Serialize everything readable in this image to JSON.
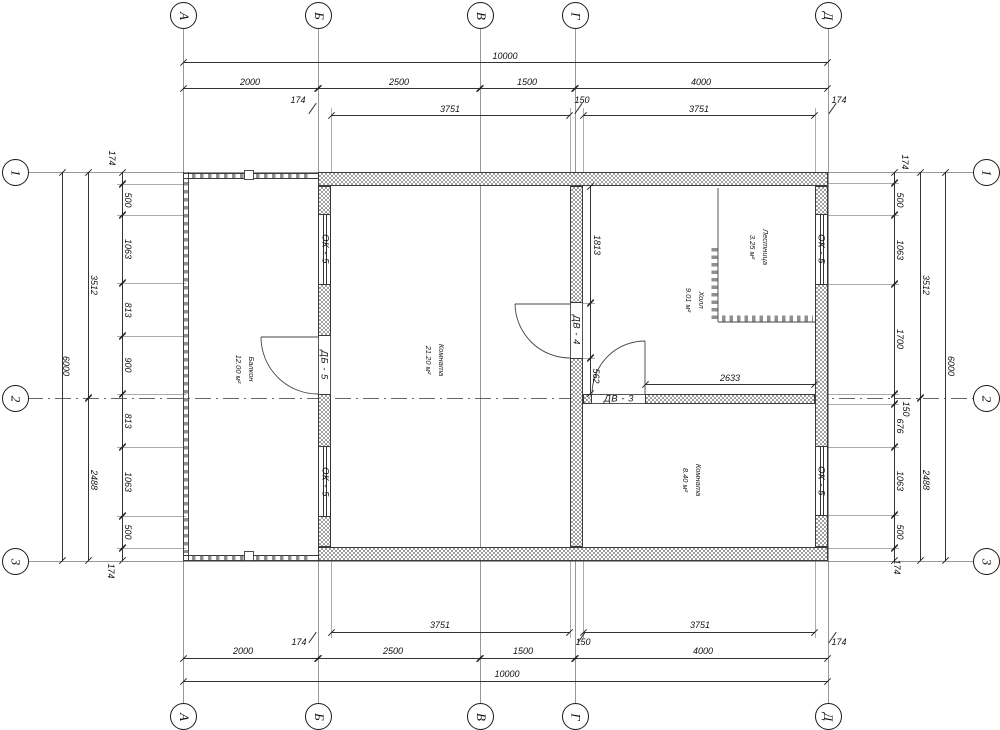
{
  "sheet": {
    "type": "architectural floor plan",
    "line_color": "#2f2f2f",
    "hatch_color": "#9f9f9f"
  },
  "axes": {
    "cols": [
      "А",
      "Б",
      "В",
      "Г",
      "Д"
    ],
    "rows": [
      "1",
      "2",
      "3"
    ]
  },
  "dims": {
    "top": {
      "overall": "10000",
      "segments": [
        "2000",
        "2500",
        "1500",
        "4000"
      ],
      "detail": [
        "174",
        "3751",
        "150",
        "3751",
        "174"
      ]
    },
    "bottom": {
      "overall": "10000",
      "segments": [
        "2000",
        "2500",
        "1500",
        "4000"
      ],
      "detail": [
        "174",
        "3751",
        "150",
        "3751",
        "174"
      ]
    },
    "left": {
      "overall": "6000",
      "spans": [
        "3512",
        "2488"
      ],
      "chain": [
        "174",
        "500",
        "1063",
        "813",
        "900",
        "813",
        "1063",
        "500",
        "174"
      ]
    },
    "right": {
      "overall": "6000",
      "spans": [
        "3512",
        "2488"
      ],
      "chain": [
        "174",
        "500",
        "1063",
        "1700",
        "150",
        "676",
        "1063",
        "500",
        "174"
      ]
    },
    "interior": {
      "upper_wall": "1813",
      "near_door": "562",
      "hall_width": "2633"
    }
  },
  "rooms": [
    {
      "name": "Балкон",
      "area": "12.00 м²"
    },
    {
      "name": "Комната",
      "area": "21.20 м²"
    },
    {
      "name": "Лестница",
      "area": "3.25 м²"
    },
    {
      "name": "Холл",
      "area": "9.01 м²"
    },
    {
      "name": "Комната",
      "area": "8.40 м²"
    }
  ],
  "openings": {
    "window": "ОК - 5",
    "balcony_door": "ДБ - 5",
    "interior_door": "ДВ - 4",
    "room_door": "ДВ - 3"
  }
}
